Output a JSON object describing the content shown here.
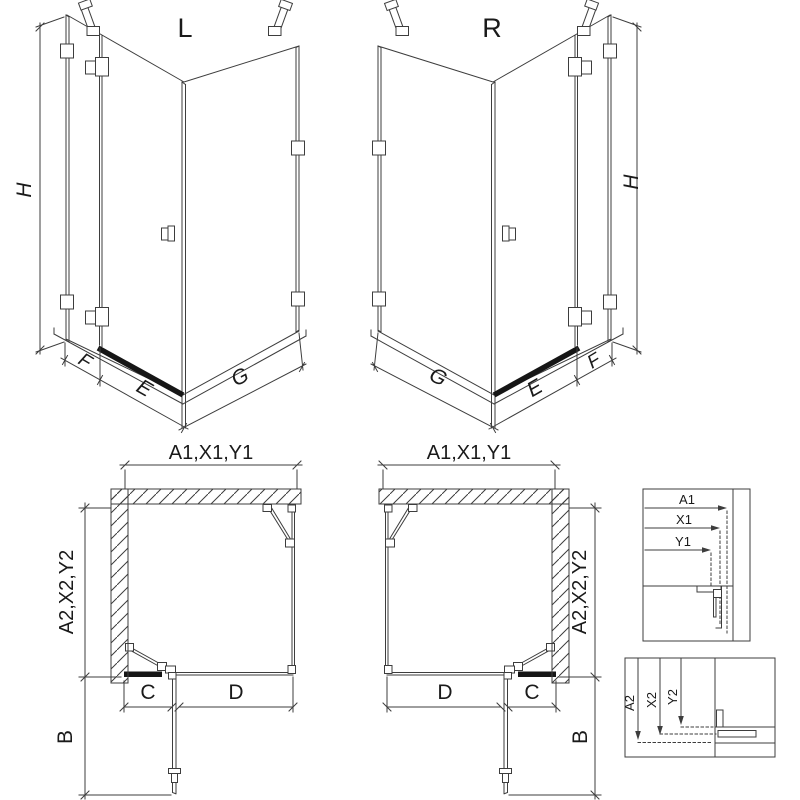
{
  "page": {
    "background": "#ffffff",
    "line_color": "#3d3d3d",
    "dark_accent": "#161616",
    "text_color": "#1a1a1a"
  },
  "iso_left": {
    "title": "L",
    "height_label": "H",
    "fixed_width_label": "F",
    "door_width_label": "E",
    "side_width_label": "G"
  },
  "iso_right": {
    "title": "R",
    "height_label": "H",
    "fixed_width_label": "F",
    "door_width_label": "E",
    "side_width_label": "G"
  },
  "plan_left": {
    "front_dim_label": "A1,X1,Y1",
    "side_dim_label": "A2,X2,Y2",
    "door_swing_label": "B",
    "door_segment_label": "C",
    "fixed_segment_label": "D"
  },
  "plan_right": {
    "front_dim_label": "A1,X1,Y1",
    "side_dim_label": "A2,X2,Y2",
    "door_swing_label": "B",
    "door_segment_label": "C",
    "fixed_segment_label": "D"
  },
  "detail_width": {
    "a1_label": "A1",
    "x1_label": "X1",
    "y1_label": "Y1"
  },
  "detail_depth": {
    "a2_label": "A2",
    "x2_label": "X2",
    "y2_label": "Y2"
  }
}
